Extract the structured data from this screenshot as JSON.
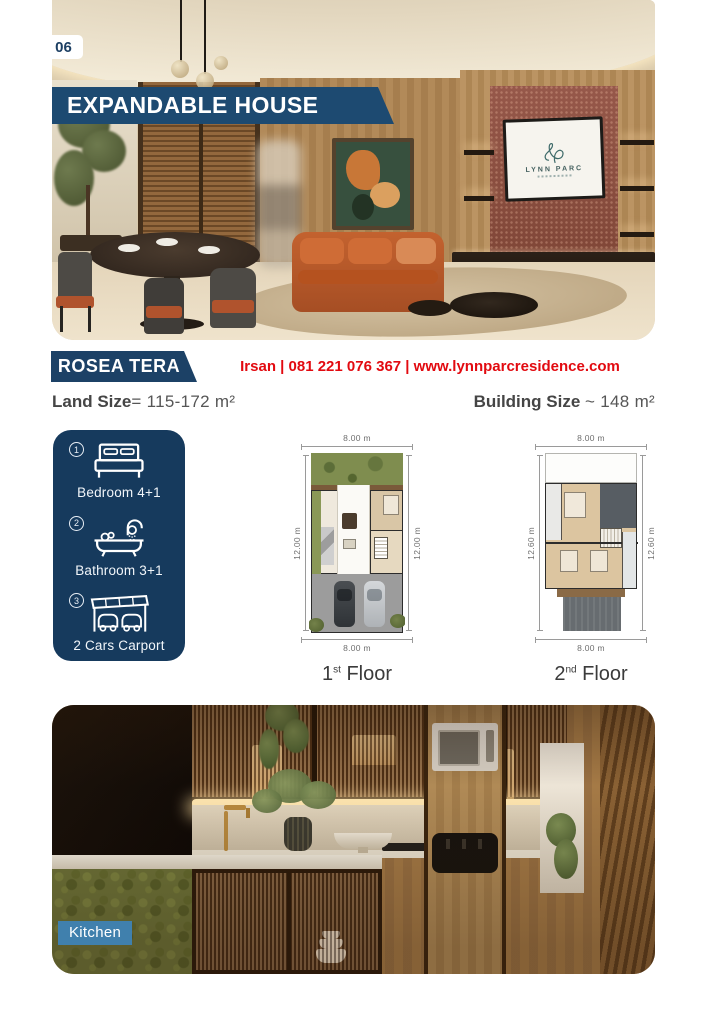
{
  "page_number": "06",
  "header": {
    "title": "EXPANDABLE HOUSE"
  },
  "hero": {
    "tv_logo": "LYNN PARC"
  },
  "listing": {
    "name": "ROSEA TERA",
    "contact": "Irsan | 081 221 076 367 | www.lynnparcresidence.com",
    "land_size": {
      "label": "Land Size",
      "value": "= 115-172 m²"
    },
    "building_size": {
      "label": "Building Size",
      "value": "~ 148 m²"
    }
  },
  "amenities": [
    {
      "number": "1",
      "label": "Bedroom 4+1"
    },
    {
      "number": "2",
      "label": "Bathroom 3+1"
    },
    {
      "number": "3",
      "label": "2 Cars Carport"
    }
  ],
  "floor_plans": [
    {
      "dim_top": "8.00 m",
      "dim_bottom": "8.00 m",
      "dim_left": "12.00 m",
      "dim_right": "12.00 m",
      "label_num": "1",
      "label_sup": "st",
      "label_rest": " Floor"
    },
    {
      "dim_top": "8.00 m",
      "dim_bottom": "8.00 m",
      "dim_left": "12.60 m",
      "dim_right": "12.60 m",
      "label_num": "2",
      "label_sup": "nd",
      "label_rest": " Floor"
    }
  ],
  "kitchen": {
    "label": "Kitchen"
  },
  "colors": {
    "navy": "#1d4a71",
    "navy_dark": "#163a5d",
    "red": "#e20a10",
    "label_blue": "#4080ad"
  }
}
